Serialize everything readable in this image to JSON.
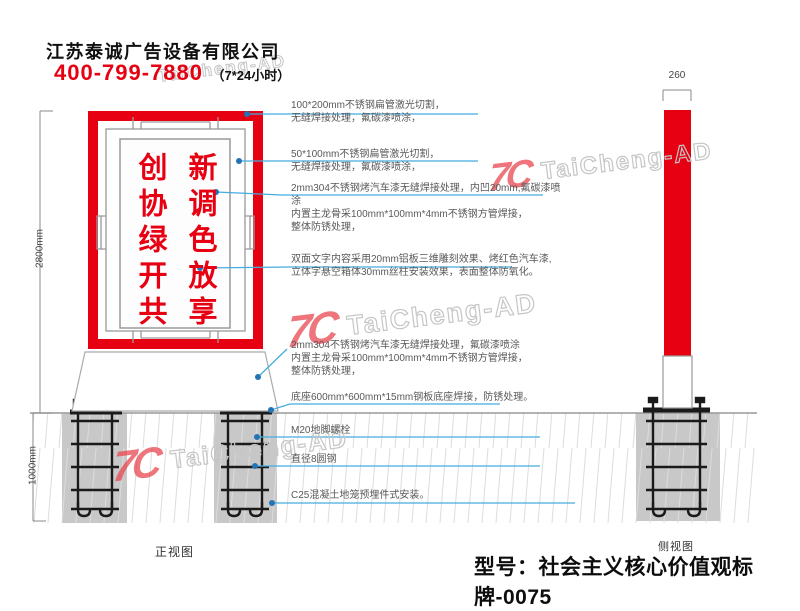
{
  "header": {
    "company": "江苏泰诚广告设备有限公司",
    "phone": "400-799-7880",
    "hours": "（7*24小时）"
  },
  "watermark": {
    "logo": "7C",
    "text": "TaiCheng-AD"
  },
  "sign": {
    "right_column": "新调色放享",
    "left_column": "创协绿开共",
    "frame_color": "#e60012",
    "text_color": "#e60012"
  },
  "annotations": [
    {
      "line1": "100*200mm不锈钢扁管激光切割，",
      "rest": "无缝焊接处理，氟碳漆喷涂，"
    },
    {
      "line1": "50*100mm不锈钢扁管激光切割，",
      "rest": "无缝焊接处理，氟碳漆喷涂，"
    },
    {
      "line1": "2mm304不锈钢烤汽车漆无缝焊接处理，内凹20mm,氟碳漆喷涂",
      "rest": "内置主龙骨采100mm*100mm*4mm不锈钢方管焊接，\n整体防锈处理，"
    },
    {
      "line1": "双面文字内容采用20mm铝板三维雕刻效果、烤红色汽车漆,",
      "rest": "立体字悬空箱体30mm丝柱安装效果，表面整体防氧化。"
    },
    {
      "line1": "2mm304不锈钢烤汽车漆无缝焊接处理，氟碳漆喷涂",
      "rest": "内置主龙骨采100mm*100mm*4mm不锈钢方管焊接，\n整体防锈处理，"
    },
    {
      "line1": "底座600mm*600mm*15mm钢板底座焊接，防锈处理。",
      "rest": ""
    },
    {
      "line1": "M20地脚螺栓",
      "rest": ""
    },
    {
      "line1": "直径8圆钢",
      "rest": ""
    },
    {
      "line1": "C25混凝土地笼预埋件式安装。",
      "rest": ""
    }
  ],
  "dimensions": {
    "upper_height": "2800mm",
    "lower_height": "1000mm",
    "side_width": "260"
  },
  "labels": {
    "front_view": "正视图",
    "side_view": "侧视图",
    "model": "型号：社会主义核心价值观标牌-0075"
  },
  "colors": {
    "red": "#e60012",
    "leader_line": "#45ace0",
    "leader_dot": "#2373b5",
    "concrete": "#c8c8c8"
  }
}
